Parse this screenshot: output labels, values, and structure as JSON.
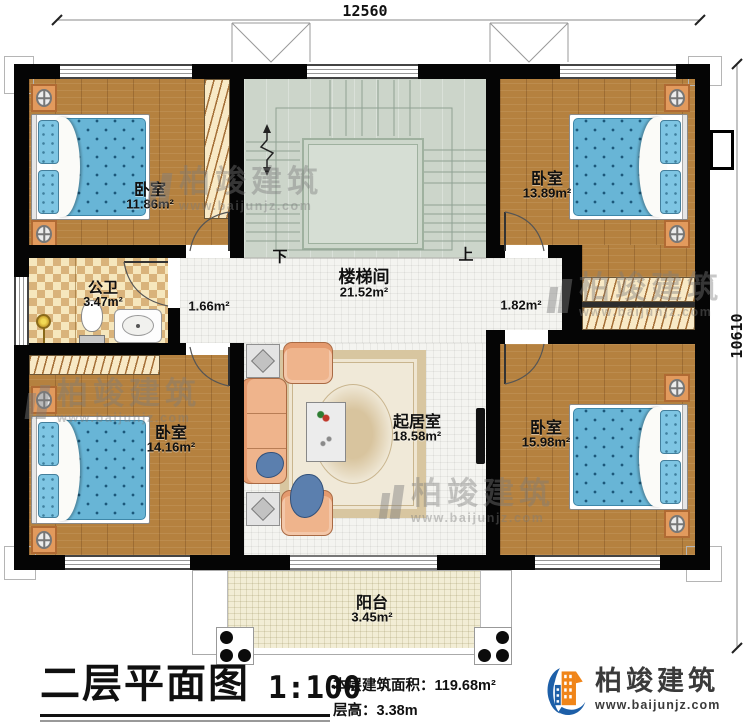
{
  "plan": {
    "dimensions": {
      "width_mm": "12560",
      "height_mm": "10610"
    },
    "rooms": {
      "bedroom_tl": {
        "name": "卧室",
        "area": "11.86m²"
      },
      "bedroom_tr": {
        "name": "卧室",
        "area": "13.89m²"
      },
      "bedroom_bl": {
        "name": "卧室",
        "area": "14.16m²"
      },
      "bedroom_br": {
        "name": "卧室",
        "area": "15.98m²"
      },
      "bathroom": {
        "name": "公卫",
        "area": "3.47m²"
      },
      "stairwell": {
        "name": "楼梯间",
        "area": "21.52m²"
      },
      "living": {
        "name": "起居室",
        "area": "18.58m²"
      },
      "balcony": {
        "name": "阳台",
        "area": "3.45m²"
      }
    },
    "halls": {
      "left_area": "1.66m²",
      "right_area": "1.82m²"
    },
    "stair_marks": {
      "down": "下",
      "up": "上"
    }
  },
  "footer": {
    "title": "二层平面图",
    "scale": "1:100",
    "area_label": "本层建筑面积：",
    "area_value": "119.68m²",
    "height_label": "层高：",
    "height_value": "3.38m"
  },
  "brand": {
    "name": "柏竣建筑",
    "website": "www.baijunjz.com"
  },
  "colors": {
    "wall": "#050505",
    "wood_floor": "#b5813f",
    "stair_floor": "#ccd5ca",
    "bathroom_tile": "#d9b37b",
    "bed_blue": "#68b5d6",
    "sofa_salmon": "#efb48c",
    "balcony_floor": "#f2edd5",
    "logo_blue": "#1d5fa8",
    "logo_orange": "#f08519"
  }
}
